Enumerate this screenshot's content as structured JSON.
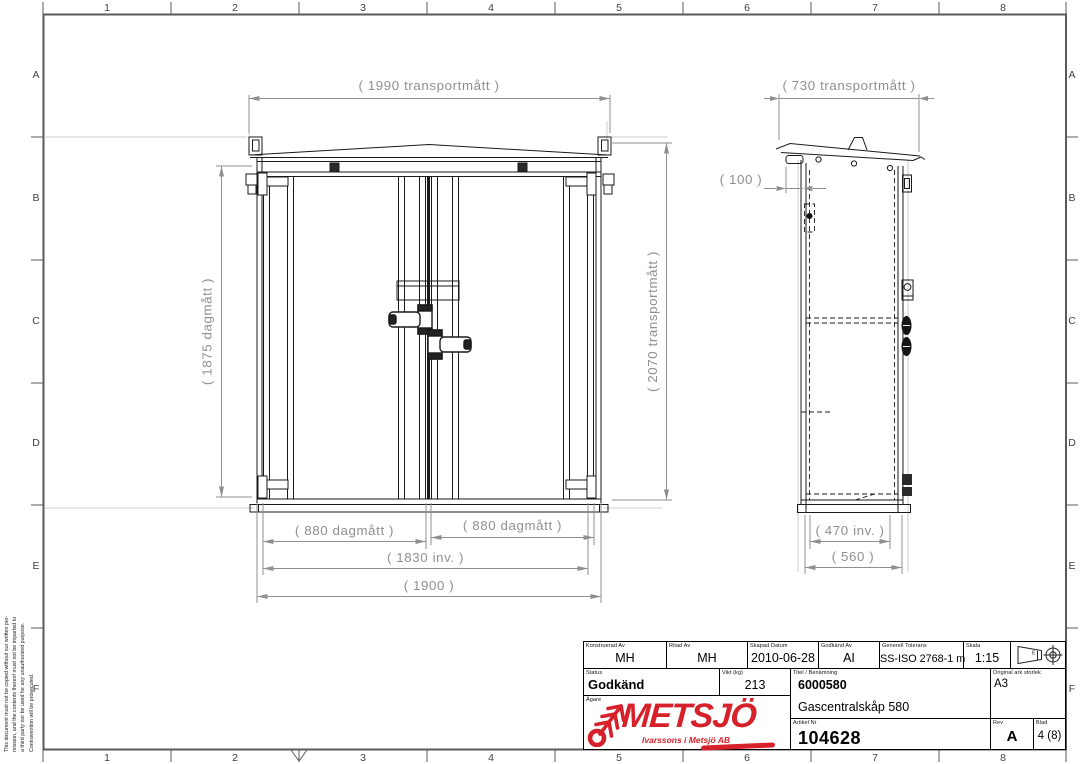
{
  "sheet": {
    "grid_columns": [
      "1",
      "2",
      "3",
      "4",
      "5",
      "6",
      "7",
      "8"
    ],
    "grid_rows": [
      "A",
      "B",
      "C",
      "D",
      "E",
      "F"
    ]
  },
  "drawing": {
    "front_view": {
      "dim_width_transport": "( 1990 transportmått )",
      "dim_height_opening": "( 1875 dagmått )",
      "dim_height_transport": "( 2070 transportmått )",
      "dim_door_left": "( 880 dagmått )",
      "dim_door_right": "( 880 dagmått )",
      "dim_width_inner": "( 1830 inv. )",
      "dim_width_overall": "( 1900 )"
    },
    "side_view": {
      "dim_depth_transport": "( 730 transportmått )",
      "dim_pipe_offset": "( 100 )",
      "dim_depth_inner": "( 470 inv. )",
      "dim_depth_overall": "( 560 )"
    }
  },
  "title_block": {
    "konstruerad_av": {
      "label": "Konstruerad Av",
      "value": "MH"
    },
    "ritad_av": {
      "label": "Ritad Av",
      "value": "MH"
    },
    "skapad_datum": {
      "label": "Skapad Datum",
      "value": "2010-06-28"
    },
    "godkand_av": {
      "label": "Godkänd Av",
      "value": "AI"
    },
    "generell_tolerans": {
      "label": "Generell Tolerans",
      "value": "SS-ISO 2768-1 m"
    },
    "skala": {
      "label": "Skala",
      "value": "1:15"
    },
    "projection_symbol_letter": "E",
    "status": {
      "label": "Status",
      "value": "Godkänd"
    },
    "vikt": {
      "label": "Vikt (kg)",
      "value": "213"
    },
    "titel": {
      "label": "Titel / Benämning",
      "article_code": "6000580",
      "product_name": "Gascentralskåp 580"
    },
    "original_ark_storlek": {
      "label": "Original ark storlek",
      "value": "A3"
    },
    "agare": {
      "label": "Ägare"
    },
    "artikel_nr": {
      "label": "Artikel Nr",
      "value": "104628"
    },
    "rev": {
      "label": "Rev",
      "value": "A"
    },
    "blad": {
      "label": "Blad",
      "value": "4 (8)"
    }
  },
  "logo": {
    "name": "METSJÖ",
    "tagline": "Ivarssons i Metsjö AB",
    "color": "#d6212a"
  },
  "copyright_note": {
    "line1": "This document must not be copied without our written per-",
    "line2": "mission, and the contents thereof must not be imparted to",
    "line3": "a third party nor be used for any unauthorized purpose.",
    "line4": "Contravention will be prosecuted."
  }
}
